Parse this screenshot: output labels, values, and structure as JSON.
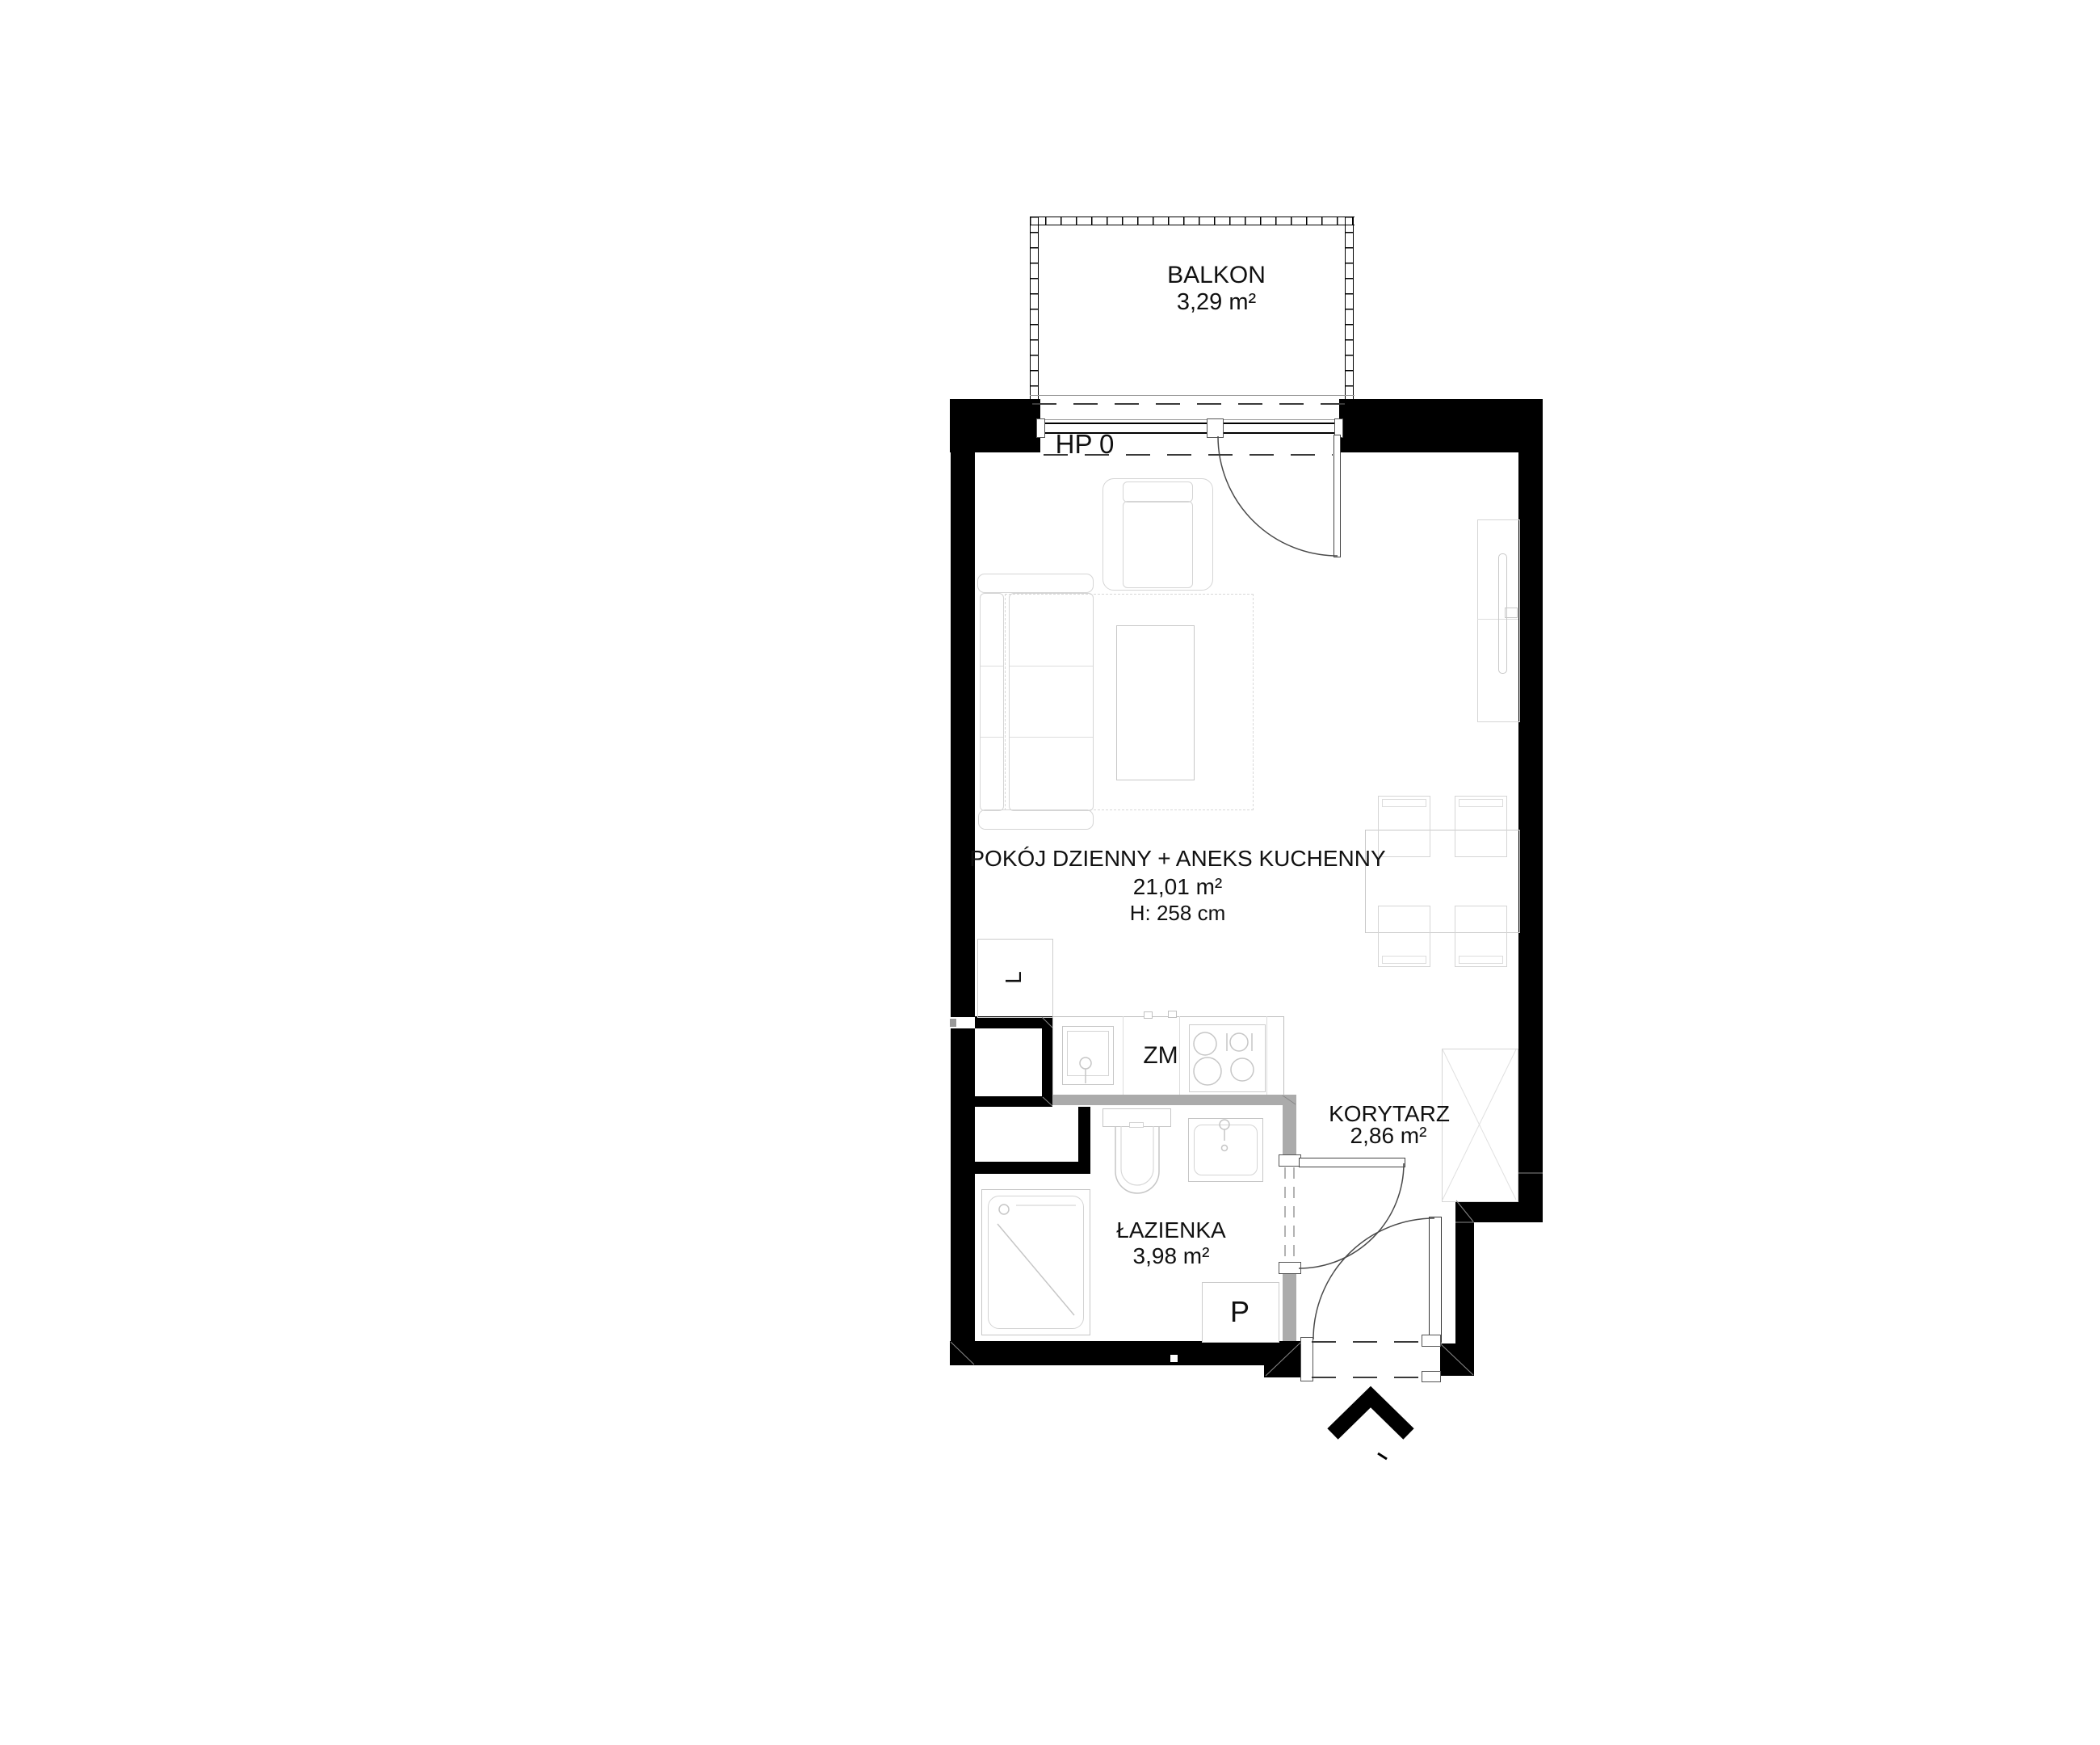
{
  "labels": {
    "balcony_name": "BALKON",
    "balcony_area": "3,29 m²",
    "window": "HP 0",
    "living_name": "POKÓJ DZIENNY + ANEKS KUCHENNY",
    "living_area": "21,01 m²",
    "living_height": "H: 258 cm",
    "dishwasher": "ZM",
    "fridge": "L",
    "corridor_name": "KORYTARZ",
    "corridor_area": "2,86 m²",
    "bathroom_name": "ŁAZIENKA",
    "bathroom_area": "3,98 m²",
    "washing_machine": "P"
  },
  "symbols": {
    "entrance_marker": "chevron-up-arrow"
  },
  "colors": {
    "wall": "#000000",
    "partition_wall": "#ababab",
    "fixture_line": "#c6c6c6",
    "furniture_line": "#d5d5d5",
    "text": "#111111"
  }
}
